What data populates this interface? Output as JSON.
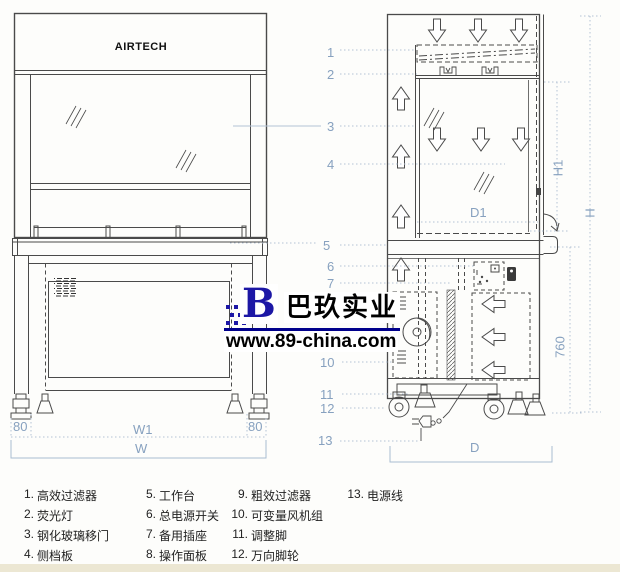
{
  "brand": "AIRTECH",
  "callouts": {
    "c1": "1",
    "c2": "2",
    "c3": "3",
    "c4": "4",
    "c5": "5",
    "c6": "6",
    "c7": "7",
    "c10": "10",
    "c11": "11",
    "c12": "12",
    "c13": "13"
  },
  "dimensions": {
    "front_left_offset": "80",
    "front_inner_width": "W1",
    "front_right_offset": "80",
    "front_total_width": "W",
    "side_inner_depth": "D1",
    "side_total_depth": "D",
    "side_opening_height": "H1",
    "side_total_height": "H",
    "side_under_height": "760"
  },
  "watermark": {
    "logo_letter": "B",
    "company": "巴玖实业",
    "url": "www.89-china.com"
  },
  "legend": {
    "items": [
      {
        "num": "1.",
        "label": "高效过滤器"
      },
      {
        "num": "2.",
        "label": "荧光灯"
      },
      {
        "num": "3.",
        "label": "钢化玻璃移门"
      },
      {
        "num": "4.",
        "label": "侧档板"
      },
      {
        "num": "5.",
        "label": "工作台"
      },
      {
        "num": "6.",
        "label": "总电源开关"
      },
      {
        "num": "7.",
        "label": "备用插座"
      },
      {
        "num": "8.",
        "label": "操作面板"
      },
      {
        "num": "9.",
        "label": "粗效过滤器"
      },
      {
        "num": "10.",
        "label": "可变量风机组"
      },
      {
        "num": "11.",
        "label": "调整脚"
      },
      {
        "num": "12.",
        "label": "万向脚轮"
      },
      {
        "num": "13.",
        "label": "电源线"
      }
    ]
  },
  "colors": {
    "line": "#4a4a4a",
    "annotation": "#87a1bf",
    "watermark_blue": "#1c17a5",
    "underline_blue": "#00008c",
    "footer_strip": "#ece7d3"
  }
}
